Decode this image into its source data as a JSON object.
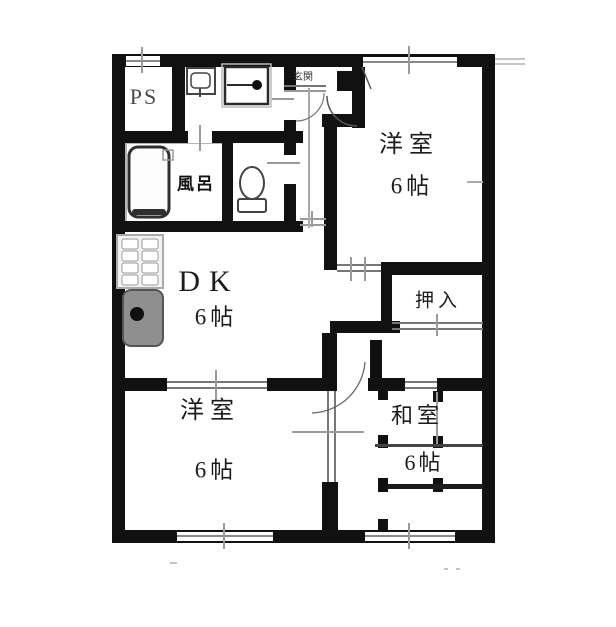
{
  "plan": {
    "type": "apartment-floor-plan",
    "rooms": {
      "ps": {
        "label": "PS"
      },
      "bath": {
        "label": "風呂"
      },
      "entrance": {
        "label": "玄関"
      },
      "western_room_top": {
        "name": "洋室",
        "size": "6帖"
      },
      "dk": {
        "name": "DK",
        "size": "6帖"
      },
      "closet": {
        "label": "押入"
      },
      "western_room_bottom": {
        "name": "洋室",
        "size": "6帖"
      },
      "japanese_room": {
        "name": "和室",
        "size": "6帖"
      }
    },
    "fixtures": [
      "bathtub",
      "toilet",
      "washbasin",
      "washing-machine",
      "stove",
      "kitchen-sink",
      "shoe-cabinet"
    ],
    "colors": {
      "wall": "#111111",
      "background": "#ffffff",
      "fixture_fill": "#8f8f8f",
      "fixture_border": "#3a3a3a",
      "line_gray": "#8a8a8a",
      "tatami_line": "#444444"
    }
  }
}
